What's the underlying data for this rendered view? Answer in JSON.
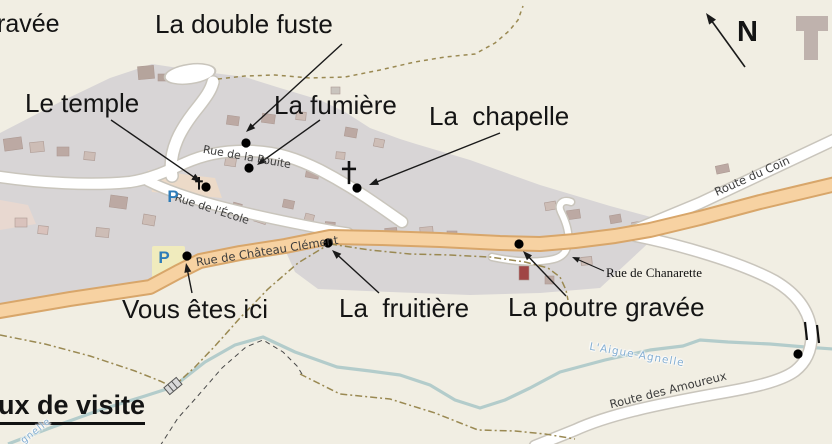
{
  "map": {
    "colors": {
      "background": "#F1EEE3",
      "urban_gray": "#D8D5D6",
      "road_orange_fill": "#F7D2A2",
      "road_orange_casing": "#D8A66A",
      "road_white_fill": "#FFFFFF",
      "road_white_casing": "#C9C5BC",
      "river": "#B3CCCB",
      "path_olive": "#9A8952",
      "path_black": "#4A4A4A",
      "parking_blue": "#2E7CB8",
      "river_label_blue": "#85AFD3",
      "annotation_black": "#141414"
    },
    "poi_labels": [
      {
        "name": "label-gravee-partial",
        "text": "ravée",
        "x": -3,
        "y": 11,
        "size": 25
      },
      {
        "name": "label-la-double-fuste",
        "text": "La double fuste",
        "x": 155,
        "y": 11,
        "size": 26
      },
      {
        "name": "label-le-temple",
        "text": "Le temple",
        "x": 25,
        "y": 90,
        "size": 26
      },
      {
        "name": "label-la-fumiere",
        "text": "La fumière",
        "x": 274,
        "y": 92,
        "size": 26
      },
      {
        "name": "label-la-chapelle",
        "text": "La  chapelle",
        "x": 429,
        "y": 103,
        "size": 26
      },
      {
        "name": "label-vous-etes-ici",
        "text": "Vous êtes ici",
        "x": 122,
        "y": 296,
        "size": 26
      },
      {
        "name": "label-la-fruitiere",
        "text": "La  fruitière",
        "x": 339,
        "y": 295,
        "size": 26
      },
      {
        "name": "label-la-poutre-gravee",
        "text": "La poutre gravée",
        "x": 508,
        "y": 294,
        "size": 26
      },
      {
        "name": "label-lieux-de-visite-partial",
        "text": "ux de visite",
        "x": -2,
        "y": 391,
        "size": 27,
        "bold": true,
        "underline": true
      },
      {
        "name": "label-north-n",
        "text": "N",
        "x": 737,
        "y": 17,
        "size": 29,
        "bold": true
      }
    ],
    "street_labels": [
      {
        "name": "street-rue-de-la-pouite",
        "text": "Rue de la Pouite",
        "x": 247,
        "y": 157,
        "rotate": 10,
        "size": 11,
        "color": "#3C3C3C"
      },
      {
        "name": "street-rue-de-l-ecole",
        "text": "Rue de l'École",
        "x": 212,
        "y": 209,
        "rotate": 18,
        "size": 11,
        "color": "#3C3C3C"
      },
      {
        "name": "street-rue-de-chateau-clement",
        "text": "Rue de Château Clément",
        "x": 267,
        "y": 251,
        "rotate": -9,
        "size": 11.5,
        "color": "#3C3C3C"
      },
      {
        "name": "street-route-du-coin",
        "text": "Route du Coin",
        "x": 752,
        "y": 176,
        "rotate": -24,
        "size": 11.5,
        "color": "#3C3C3C"
      },
      {
        "name": "street-route-des-amoureux",
        "text": "Route des Amoureux",
        "x": 668,
        "y": 390,
        "rotate": -14,
        "size": 11.5,
        "color": "#3C3C3C"
      },
      {
        "name": "street-rue-de-chanarette",
        "text": "Rue de Chanarette",
        "x": 654,
        "y": 273,
        "rotate": 0,
        "size": 13,
        "color": "#111111",
        "serif": true
      },
      {
        "name": "river-label-aigue-agnelle",
        "text": "L'Aigue-Agnelle",
        "x": 637,
        "y": 355,
        "rotate": 10,
        "size": 10.5,
        "color": "#85AFD3",
        "halo": true
      },
      {
        "name": "river-label-corner",
        "text": "gnelle",
        "x": 36,
        "y": 431,
        "rotate": -38,
        "size": 9.5,
        "color": "#85AFD3",
        "halo": true
      }
    ],
    "parking_markers": [
      {
        "name": "parking-p-upper",
        "label": "P",
        "x": 173,
        "y": 197
      },
      {
        "name": "parking-p-lower",
        "label": "P",
        "x": 164,
        "y": 258
      }
    ],
    "poi_dots": [
      {
        "name": "dot-la-double-fuste",
        "x": 246,
        "y": 143
      },
      {
        "name": "dot-la-fumiere",
        "x": 249,
        "y": 168
      },
      {
        "name": "dot-le-temple",
        "x": 206,
        "y": 187
      },
      {
        "name": "dot-la-chapelle",
        "x": 357,
        "y": 188
      },
      {
        "name": "dot-vous-etes-ici",
        "x": 187,
        "y": 256
      },
      {
        "name": "dot-la-fruitiere",
        "x": 328,
        "y": 243
      },
      {
        "name": "dot-la-poutre-gravee",
        "x": 519,
        "y": 244
      },
      {
        "name": "dot-route-bend",
        "x": 798,
        "y": 354
      }
    ],
    "crosses": [
      {
        "name": "cross-chapelle",
        "x": 349,
        "y": 172,
        "size": 22,
        "stroke": 2.6
      },
      {
        "name": "cross-temple",
        "x": 199,
        "y": 183,
        "size": 12,
        "stroke": 2
      }
    ],
    "arrows": [
      {
        "name": "arrow-la-double-fuste",
        "x1": 342,
        "y1": 44,
        "x2": 246,
        "y2": 132,
        "w": 1.4,
        "head": 10
      },
      {
        "name": "arrow-le-temple",
        "x1": 111,
        "y1": 120,
        "x2": 201,
        "y2": 182,
        "w": 1.4,
        "head": 10
      },
      {
        "name": "arrow-la-fumiere",
        "x1": 320,
        "y1": 120,
        "x2": 257,
        "y2": 165,
        "w": 1.4,
        "head": 10
      },
      {
        "name": "arrow-la-chapelle",
        "x1": 500,
        "y1": 133,
        "x2": 369,
        "y2": 185,
        "w": 1.4,
        "head": 10
      },
      {
        "name": "arrow-vous-etes-ici",
        "x1": 192,
        "y1": 293,
        "x2": 186,
        "y2": 263,
        "w": 1.4,
        "head": 10
      },
      {
        "name": "arrow-la-fruitiere",
        "x1": 379,
        "y1": 293,
        "x2": 332,
        "y2": 250,
        "w": 1.4,
        "head": 10
      },
      {
        "name": "arrow-la-poutre-gravee",
        "x1": 566,
        "y1": 296,
        "x2": 523,
        "y2": 251,
        "w": 1.4,
        "head": 10
      },
      {
        "name": "arrow-rue-de-chanarette",
        "x1": 604,
        "y1": 271,
        "x2": 572,
        "y2": 257,
        "w": 1.1,
        "head": 8
      },
      {
        "name": "arrow-north",
        "x1": 745,
        "y1": 67,
        "x2": 706,
        "y2": 13,
        "w": 1.6,
        "head": 12
      }
    ]
  }
}
